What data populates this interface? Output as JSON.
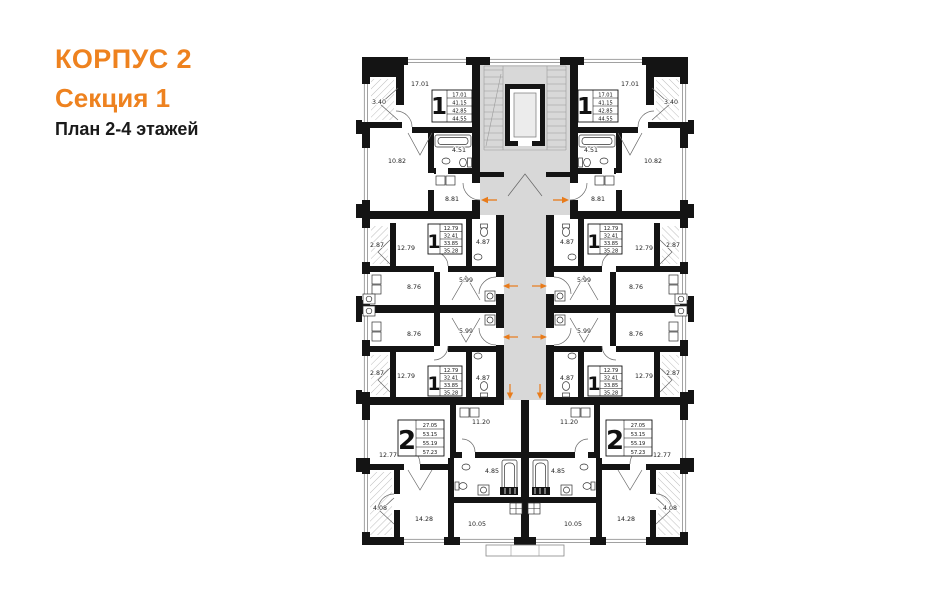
{
  "header": {
    "building": "КОРПУС 2",
    "section": "Секция 1",
    "plan": "План 2-4 этажей"
  },
  "apartments": {
    "one_room_top": {
      "type": "1",
      "living": "17.01",
      "area1": "41.15",
      "area2": "42.85",
      "total": "44.55"
    },
    "one_room_middle": {
      "type": "1",
      "living": "12.79",
      "area1": "32.41",
      "area2": "33.85",
      "total": "35.28"
    },
    "two_room": {
      "type": "2",
      "living": "27.05",
      "area1": "53.15",
      "area2": "55.19",
      "total": "57.23"
    }
  },
  "room_areas": {
    "living_top": "17.01",
    "balcony_top": "3.40",
    "bedroom_top": "10.82",
    "bath_top": "4.51",
    "kitchen_top": "8.81",
    "room_mid": "12.79",
    "balcony_mid": "2.87",
    "bath_mid": "4.87",
    "hall_mid": "5.99",
    "kitchen_mid": "8.76",
    "kitchen_2room": "11.20",
    "room_2room": "12.77",
    "bath_2room": "4.85",
    "balcony_2room": "4.08",
    "bedroom_2room": "14.28",
    "room_center": "10.05"
  },
  "colors": {
    "wall": "#141414",
    "corridor": "#d8d8d8",
    "arrow": "#e87b1a"
  }
}
